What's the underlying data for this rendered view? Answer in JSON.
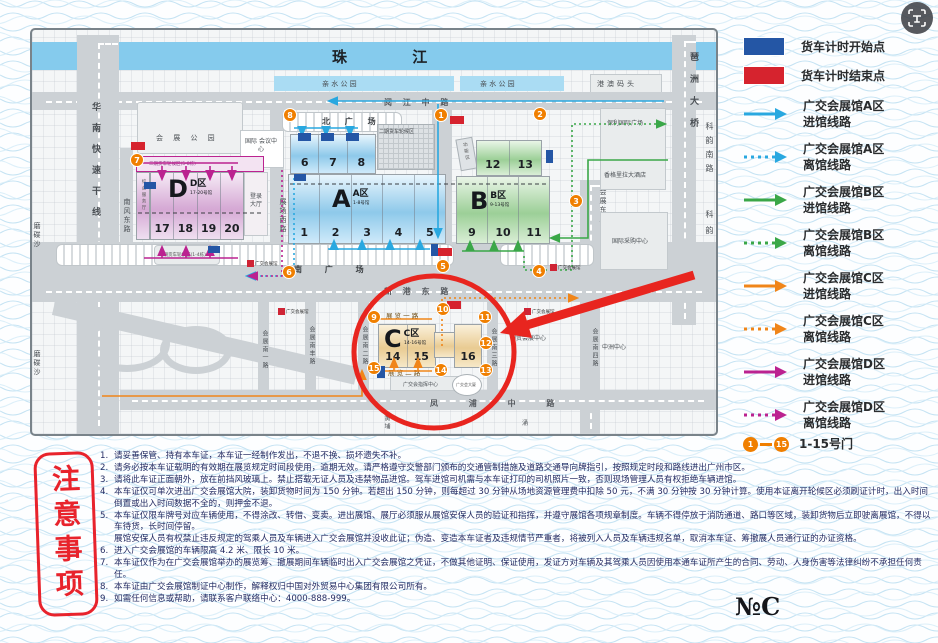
{
  "colors": {
    "legend_start": "#2456a5",
    "legend_end": "#d6232e",
    "route_a": "#29a8e0",
    "route_b": "#3aa748",
    "route_c": "#f08519",
    "route_d": "#bb2290",
    "gate": "#f07f00",
    "annotation_red": "#e8251f"
  },
  "map": {
    "river": "珠    江",
    "park_left": "亲 水 公 园",
    "park_right": "亲 水 公 园",
    "pier": "港澳码头",
    "roads": {
      "yuejiang": "阅 江 中 路",
      "huanan": "华南快速干线",
      "nanfeng_dong": "南风东路",
      "zhanchang_xi": "展场西路",
      "zhanchang_zhong": "展场中路",
      "zhanchang_dong": "展场东路",
      "huizhan_dong": "会展东路",
      "pazhou_bridge": "琶洲大桥",
      "keyun_nan": "科韵南路",
      "keyun": "科韵路",
      "keyun_interchange": "科韵路立交桥",
      "xingang_dong": "新 港 东 路",
      "fengpu_zhong": "凤  浦  中  路",
      "huizhan_nan1": "会展南一路",
      "huizhan_nanfeng": "会展南丰路",
      "huizhan_nan2": "会展南二路",
      "huizhan_nan3": "会展南三路",
      "huizhan_nan4": "会展南四路",
      "zhanlan1": "展 览 一 路",
      "zhanlan2": "展 览 二 路"
    },
    "places": {
      "north_square": "北 广 场",
      "south_square": "南  广  场",
      "exhibition_park": "会 展 公 园",
      "intl_conference": "国际 会议中心",
      "login_hall": "登录 大厅",
      "service_hall": "综合服务厅",
      "queue_area1": "一期货车轮候区(1-4栋)",
      "queue_area2": "二期货车轮候区",
      "queue_strip": "二期货车轮候区(5-8栋)",
      "function_zone": "功能区",
      "poly_plaza": "保利国际广场",
      "shangrila": "香格里拉大酒店",
      "intl_sourcing": "国际采购中心",
      "guomao_center": "国贸会展中心",
      "zhongzhou": "中洲中心",
      "command_center": "广交会指挥中心",
      "gjh_tower": "广交会大厦",
      "modiesha1": "磨碟沙",
      "modiesha2": "磨碟沙",
      "huangpu": "黄埔",
      "chong": "涌",
      "logo_text": "广交会展馆"
    },
    "zones": {
      "a": {
        "big": "A",
        "name": "A区",
        "sub": "1-8号馆",
        "halls": [
          "1",
          "2",
          "3",
          "4",
          "5"
        ],
        "halls_top": [
          "6",
          "7",
          "8"
        ]
      },
      "b": {
        "big": "B",
        "name": "B区",
        "sub": "9-13号馆",
        "halls": [
          "9",
          "10",
          "11"
        ],
        "halls_top": [
          "12",
          "13"
        ]
      },
      "c": {
        "big": "C",
        "name": "C区",
        "sub": "14-16号馆",
        "halls": [
          "14",
          "15",
          "16"
        ]
      },
      "d": {
        "big": "D",
        "name": "D区",
        "sub": "17-20号馆",
        "halls": [
          "17",
          "18",
          "19",
          "20"
        ]
      }
    },
    "gates": [
      "1",
      "2",
      "3",
      "4",
      "5",
      "6",
      "7",
      "8",
      "9",
      "10",
      "11",
      "12",
      "13",
      "14",
      "15"
    ]
  },
  "legend": {
    "items": [
      {
        "type": "rect",
        "color": "#2456a5",
        "label": "货车计时开始点"
      },
      {
        "type": "rect",
        "color": "#d6232e",
        "label": "货车计时结束点"
      },
      {
        "type": "arrow",
        "style": "solid",
        "color": "#29a8e0",
        "label1": "广交会展馆A区",
        "label2": "进馆线路"
      },
      {
        "type": "arrow",
        "style": "dashed",
        "color": "#29a8e0",
        "label1": "广交会展馆A区",
        "label2": "离馆线路"
      },
      {
        "type": "arrow",
        "style": "solid",
        "color": "#3aa748",
        "label1": "广交会展馆B区",
        "label2": "进馆线路"
      },
      {
        "type": "arrow",
        "style": "dashed",
        "color": "#3aa748",
        "label1": "广交会展馆B区",
        "label2": "离馆线路"
      },
      {
        "type": "arrow",
        "style": "solid",
        "color": "#f08519",
        "label1": "广交会展馆C区",
        "label2": "进馆线路"
      },
      {
        "type": "arrow",
        "style": "dashed",
        "color": "#f08519",
        "label1": "广交会展馆C区",
        "label2": "离馆线路"
      },
      {
        "type": "arrow",
        "style": "solid",
        "color": "#bb2290",
        "label1": "广交会展馆D区",
        "label2": "进馆线路"
      },
      {
        "type": "arrow",
        "style": "dashed",
        "color": "#bb2290",
        "label1": "广交会展馆D区",
        "label2": "离馆线路"
      },
      {
        "type": "gates",
        "start": "1",
        "end": "15",
        "label": "1-15号门"
      }
    ]
  },
  "notes": {
    "title": "注意事项",
    "items": [
      {
        "num": "1.",
        "text": "请妥善保管、持有本车证，本车证一经制作发出，不退不换、损坏遗失不补。"
      },
      {
        "num": "2.",
        "text": "请务必按本车证载明的有效期在展览规定时间段使用，逾期无效。请严格遵守交警部门颁布的交通管制措施及道路交通导向牌指引，按照规定时段和路线进出广州市区。"
      },
      {
        "num": "3.",
        "text": "请将此车证正面朝外，放在前挡风玻璃上。禁止搭载无证人员及违禁物品进馆。驾车进馆司机需与本车证打印的司机照片一致，否则现场管理人员有权拒绝车辆进馆。"
      },
      {
        "num": "4.",
        "text": "本车证仅可单次进出广交会展馆大院，装卸货物时间为 150 分钟。若超出 150 分钟，则每超过 30 分钟从场地资源管理费中扣除 50 元，不满 30 分钟按 30 分钟计算。使用本证离开轮候区必须刷证计时，出入时间倒置或出入时间数据不全的，则押金不退。"
      },
      {
        "num": "5.",
        "text": "本车证仅限车牌号对应车辆使用，不得涂改、转借、变卖。进出展馆、展厅必须服从展馆安保人员的验证和指挥，并遵守展馆各项规章制度。车辆不得停放于消防通道、路口等区域，装卸货物后立即驶离展馆，不得以车待货，长时间停留。",
        "text2": "展馆安保人员有权禁止违反规定的驾乘人员及车辆进入广交会展馆并没收此证；伪造、变造本车证者及违规情节严重者，将被列入人员及车辆违规名单，取消本车证、筹撤展人员通行证的办证资格。"
      },
      {
        "num": "6.",
        "text": "进入广交会展馆的车辆限高 4.2 米、限长 10 米。"
      },
      {
        "num": "7.",
        "text": "本车证仅作为在广交会展馆举办的展览筹、撤展期间车辆临时出入广交会展馆之凭证，不做其他证明、保证使用，发证方对车辆及其驾乘人员因使用本通车证所产生的合同、劳动、人身伤害等法律纠纷不承担任何责任。"
      },
      {
        "num": "8.",
        "text": "本车证由广交会展馆制证中心制作，解释权归中国对外贸易中心集团有限公司所有。"
      },
      {
        "num": "9.",
        "text": "如需任何信息或帮助，请联系客户联络中心：4000-888-999。"
      }
    ]
  },
  "footer": {
    "mark": "№C"
  }
}
